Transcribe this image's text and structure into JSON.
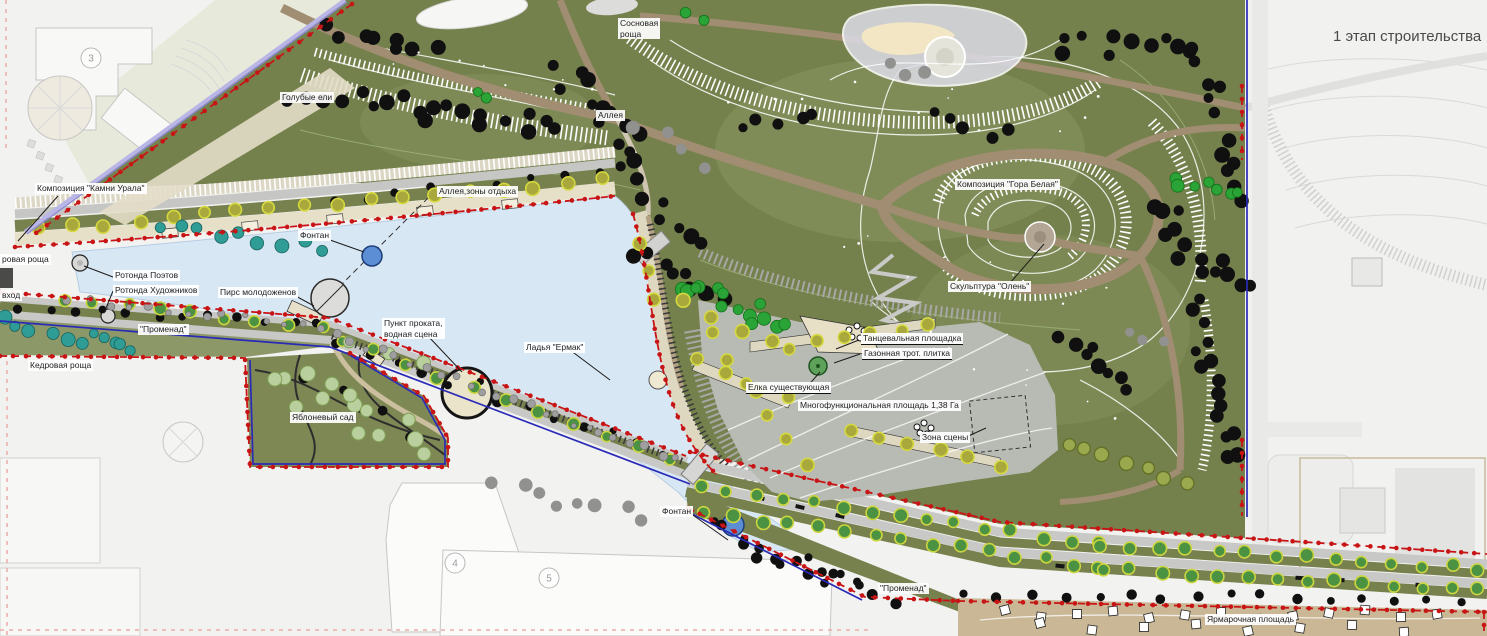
{
  "title": "1 этап строительства",
  "labels": {
    "kamni_urala": "Композиция \"Камни Урала\"",
    "rovaya_roshcha": "ровая роща",
    "vhod": "вход",
    "rotonda_poetov": "Ротонда Поэтов",
    "rotonda_hudozhnikov": "Ротонда Художников",
    "pirs_molodozhenov": "Пирс молодоженов",
    "fontan_upper": "Фонтан",
    "promenad_west": "\"Променад\"",
    "kedrovaya_roshcha": "Кедровая роща",
    "punkt_prokata": "Пункт проката,\nводная сцена",
    "ladya_ermak": "Ладья \"Ермак\"",
    "yablonevy_sad": "Яблоневый сад",
    "alleya_zony_otdyha": "Аллея,зоны отдыха",
    "golubye_eli": "Голубые ели",
    "alleya": "Аллея",
    "sosnovaya_roshcha": "Сосновая\nроща",
    "gora_belaya": "Композиция \"Гора Белая\"",
    "skulptura_olen": "Скульптура \"Олень\"",
    "tantsevalnaya_ploshchadka": "Танцевальная площадка",
    "gazonnaya_plitka": "Газонная трот. плитка",
    "elka_sushchestvuyushchaya": "Елка существующая",
    "mnogofunktsionalnaya_ploshchad": "Многофункциональная площадь 1,38 Га",
    "zona_stseny": "Зона сцены",
    "fontan_lower": "Фонтан",
    "promenad_south": "\"Променад\"",
    "yarmarochnaya_ploshchad": "Ярмарочная площадь"
  },
  "building_numbers": [
    "3",
    "4",
    "5"
  ],
  "colors": {
    "water": "#d8e7f4",
    "hill_green": "#75814d",
    "plaza_gray": "#b8bbb4",
    "path_brown": "#a18d71",
    "boundary_red": "#c81414",
    "boundary_blue": "#2a2ab8",
    "boundary_lavender": "#b9b5e6",
    "tree_dark": "#101010",
    "tree_green": "#2aa437",
    "tree_olive": "#a9a83c",
    "shrub_teal": "#2f9c96",
    "fountain_blue": "#5c8ed6",
    "fair_ground": "#c9b795",
    "faded_context": "#f2f2f1"
  }
}
